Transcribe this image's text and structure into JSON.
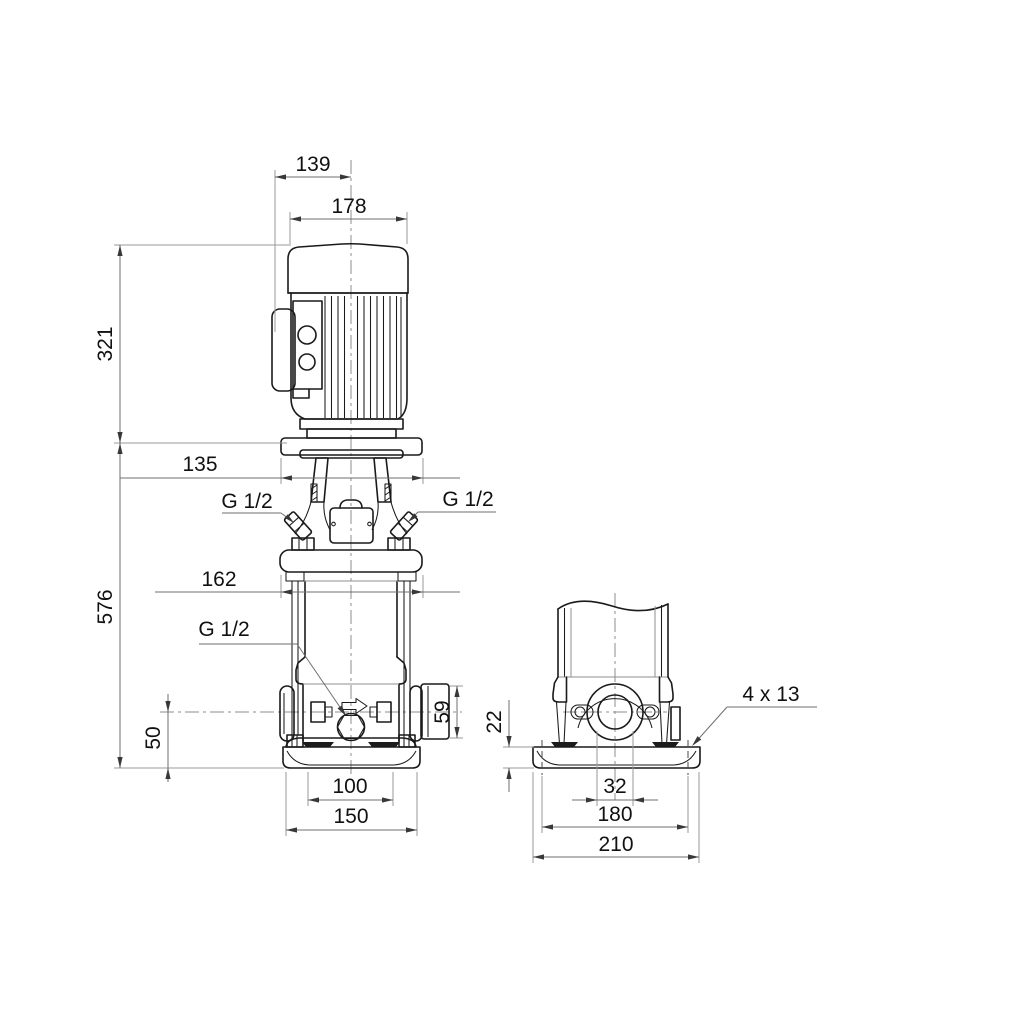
{
  "drawing": {
    "kind": "pump-dimensional-drawing",
    "background_color": "#ffffff",
    "object_line_color": "#1a1a1a",
    "dimension_line_color": "#6f6f6f",
    "front_view": {
      "dim_motor_offset": "139",
      "dim_motor_width": "178",
      "dim_motor_height": "321",
      "dim_head_width": "135",
      "dim_pump_height": "576",
      "dim_flange_width": "162",
      "vent_plug_left_label": "G 1/2",
      "vent_plug_right_label": "G 1/2",
      "drain_plug_label": "G 1/2",
      "dim_port_centerline_height": "50",
      "dim_port_block_height": "59",
      "dim_base_slot_spacing": "100",
      "dim_base_width": "150"
    },
    "side_view": {
      "dim_base_plate_thickness": "22",
      "bolt_holes_label": "4 x 13",
      "dim_port_bore": "32",
      "dim_bolt_hole_spacing": "180",
      "dim_base_length": "210"
    }
  }
}
